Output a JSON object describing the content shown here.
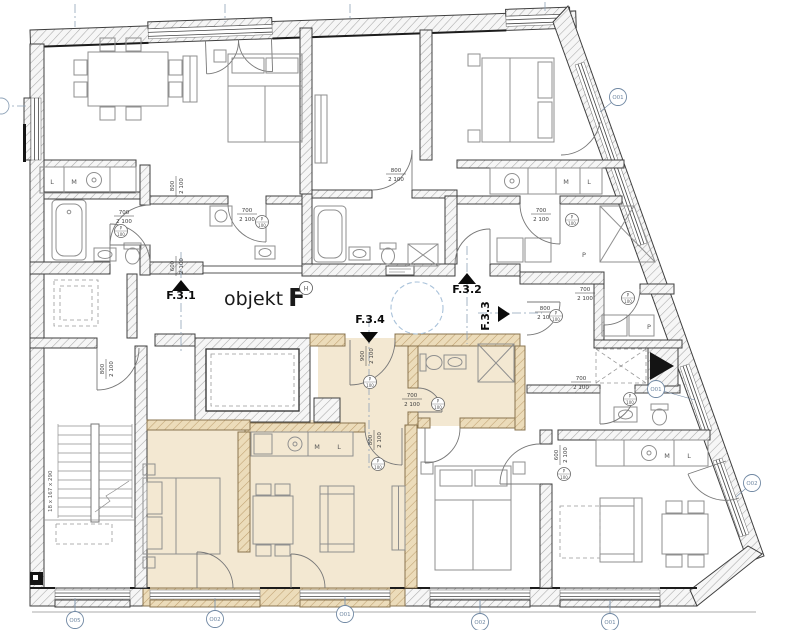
{
  "drawing": {
    "title": {
      "object_label": "objekt",
      "object_letter": "F",
      "badge": "H"
    },
    "stair_label": "18 x 167 x 290",
    "corridor_units": [
      "F.3.1",
      "F.3.2",
      "F.3.3",
      "F.3.4"
    ]
  },
  "colors": {
    "highlight_room": "#f3e8d2",
    "highlight_wall": "#ecdcba",
    "wall_hatch": "#a8a8a8",
    "annotation_blue": "#7088a3",
    "marker_black": "#0b0b0b"
  },
  "annotations": {
    "unit_markers": [
      {
        "id": "F.3.1",
        "lx": 181,
        "ly": 299,
        "dir": "up",
        "tx": 181,
        "ty": 280,
        "rot": 0
      },
      {
        "id": "F.3.2",
        "lx": 467,
        "ly": 293,
        "dir": "up",
        "tx": 467,
        "ty": 273,
        "rot": 0
      },
      {
        "id": "F.3.3",
        "lx": 489,
        "ly": 316,
        "dir": "right",
        "tx": 510,
        "ty": 314,
        "rot": -90
      },
      {
        "id": "F.3.4",
        "lx": 370,
        "ly": 323,
        "dir": "down",
        "tx": 369,
        "ty": 343,
        "rot": 0
      }
    ],
    "door_dimensions": [
      {
        "w": "700",
        "h": "2 100",
        "x": 124,
        "y": 216,
        "r": 0
      },
      {
        "w": "800",
        "h": "2 100",
        "x": 176,
        "y": 186,
        "r": 90
      },
      {
        "w": "700",
        "h": "2 100",
        "x": 247,
        "y": 214,
        "r": 0
      },
      {
        "w": "800",
        "h": "2 100",
        "x": 396,
        "y": 174,
        "r": 0
      },
      {
        "w": "700",
        "h": "2 100",
        "x": 541,
        "y": 214,
        "r": 0
      },
      {
        "w": "600",
        "h": "2 100",
        "x": 176,
        "y": 266,
        "r": 90
      },
      {
        "w": "800",
        "h": "2 100",
        "x": 545,
        "y": 312,
        "r": 0
      },
      {
        "w": "900",
        "h": "2 100",
        "x": 366,
        "y": 356,
        "r": 90
      },
      {
        "w": "700",
        "h": "2 100",
        "x": 412,
        "y": 399,
        "r": 0
      },
      {
        "w": "800",
        "h": "2 100",
        "x": 374,
        "y": 440,
        "r": 90
      },
      {
        "w": "700",
        "h": "2 100",
        "x": 585,
        "y": 293,
        "r": 0
      },
      {
        "w": "700",
        "h": "2 100",
        "x": 581,
        "y": 382,
        "r": 0
      },
      {
        "w": "600",
        "h": "2 100",
        "x": 560,
        "y": 455,
        "r": 90
      },
      {
        "w": "800",
        "h": "2 100",
        "x": 106,
        "y": 369,
        "r": 90
      }
    ],
    "door_tags": [
      {
        "l1": "P",
        "l2": "100",
        "x": 121,
        "y": 231
      },
      {
        "l1": "P",
        "l2": "100",
        "x": 262,
        "y": 222
      },
      {
        "l1": "P",
        "l2": "100",
        "x": 370,
        "y": 382
      },
      {
        "l1": "P",
        "l2": "100",
        "x": 438,
        "y": 404
      },
      {
        "l1": "P",
        "l2": "100",
        "x": 556,
        "y": 316
      },
      {
        "l1": "P",
        "l2": "100",
        "x": 572,
        "y": 220
      },
      {
        "l1": "P",
        "l2": "100",
        "x": 628,
        "y": 298
      },
      {
        "l1": "P",
        "l2": "100",
        "x": 630,
        "y": 399
      },
      {
        "l1": "P",
        "l2": "100",
        "x": 564,
        "y": 474
      },
      {
        "l1": "P",
        "l2": "100",
        "x": 378,
        "y": 464
      }
    ],
    "window_tags": [
      {
        "label": "O05",
        "x": 75,
        "y": 620,
        "lead": [
          75,
          600
        ]
      },
      {
        "label": "O02",
        "x": 215,
        "y": 619,
        "lead": [
          215,
          600
        ]
      },
      {
        "label": "O01",
        "x": 345,
        "y": 614,
        "lead": [
          345,
          597
        ]
      },
      {
        "label": "O02",
        "x": 480,
        "y": 622,
        "lead": [
          480,
          601
        ]
      },
      {
        "label": "O01",
        "x": 610,
        "y": 622,
        "lead": [
          610,
          601
        ]
      },
      {
        "label": "O01",
        "x": 618,
        "y": 97,
        "lead": [
          600,
          112
        ]
      },
      {
        "label": "O01",
        "x": 656,
        "y": 389,
        "lead": [
          695,
          400
        ]
      },
      {
        "label": "O02",
        "x": 752,
        "y": 483,
        "lead": [
          736,
          497
        ]
      }
    ],
    "room_labels": [
      {
        "t": "L",
        "x": 52,
        "y": 184
      },
      {
        "t": "M",
        "x": 74,
        "y": 184
      },
      {
        "t": "M",
        "x": 566,
        "y": 184
      },
      {
        "t": "L",
        "x": 589,
        "y": 184
      },
      {
        "t": "P",
        "x": 584,
        "y": 257
      },
      {
        "t": "P",
        "x": 649,
        "y": 329
      },
      {
        "t": "M",
        "x": 317,
        "y": 449
      },
      {
        "t": "L",
        "x": 339,
        "y": 449
      },
      {
        "t": "M",
        "x": 667,
        "y": 458
      },
      {
        "t": "L",
        "x": 689,
        "y": 458
      }
    ]
  }
}
